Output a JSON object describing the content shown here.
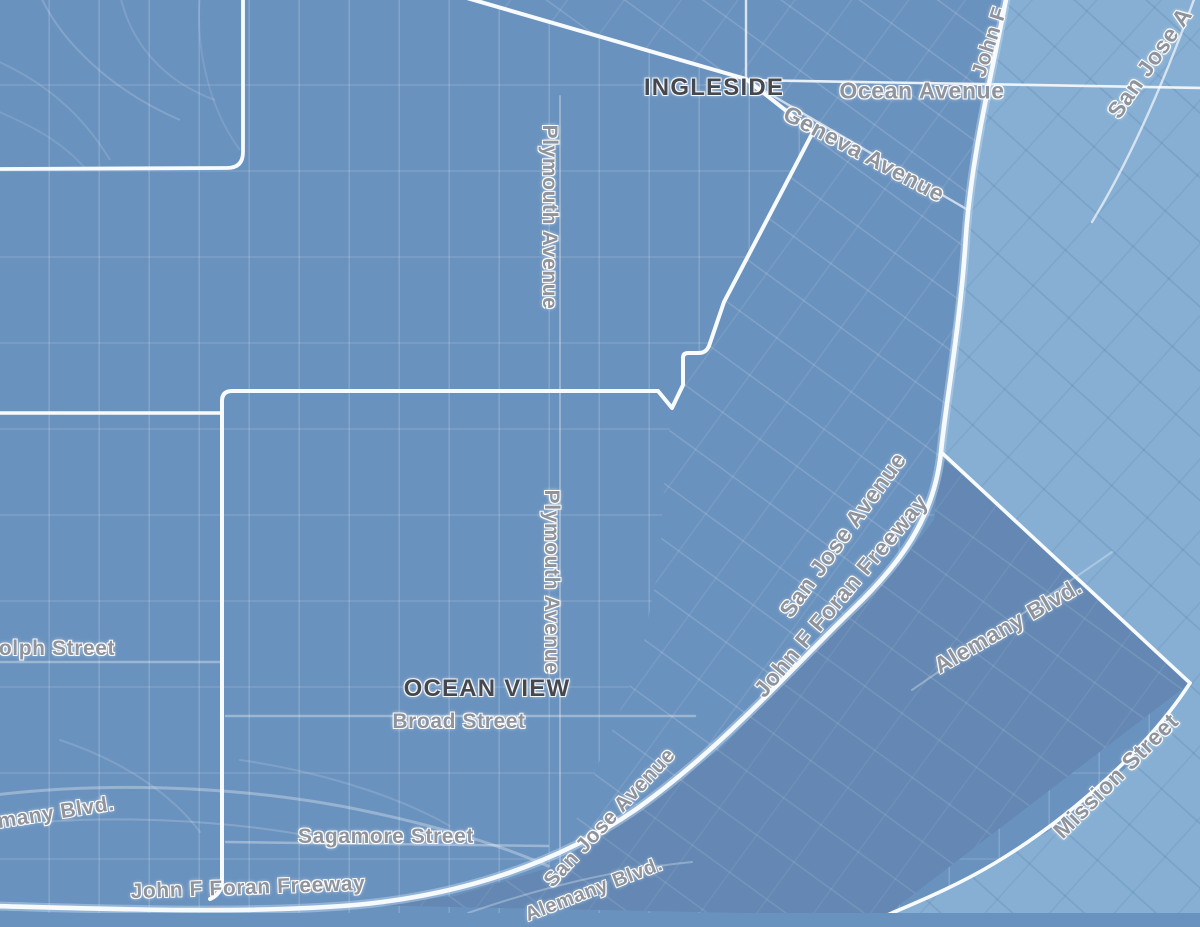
{
  "map": {
    "kind": "choropleth-street-map",
    "neighborhood_labels": {
      "ingleside": "INGLESIDE",
      "ocean_view": "OCEAN VIEW"
    },
    "street_labels": {
      "ocean_avenue": "Ocean Avenue",
      "geneva_avenue": "Geneva Avenue",
      "plymouth_avenue_north": "Plymouth Avenue",
      "plymouth_avenue_south": "Plymouth Avenue",
      "san_jose_avenue_mid": "San Jose Avenue",
      "john_f_foran_freeway_mid": "John F Foran Freeway",
      "alemany_blvd_right": "Alemany Blvd.",
      "mission_street": "Mission Street",
      "broad_street": "Broad Street",
      "sagamore_street": "Sagamore Street",
      "john_f_foran_freeway_bottom": "John F Foran Freeway",
      "san_jose_avenue_bottom": "San Jose Avenue",
      "alemany_blvd_bottom": "Alemany Blvd.",
      "randolph_street_partial": "olph Street",
      "alemany_blvd_left_partial": "many Blvd.",
      "san_jose_avenue_top": "San Jose A",
      "john_f_foran_freeway_top": "John F"
    },
    "colors": {
      "region_base_blue": "#6a92be",
      "region_light_blue": "#86afd3",
      "region_dark_blue": "#6488b3",
      "boundary_white": "#f8fbfe",
      "street_label_gray": "#8e939c",
      "neighborhood_label_dark": "#45494f"
    }
  }
}
